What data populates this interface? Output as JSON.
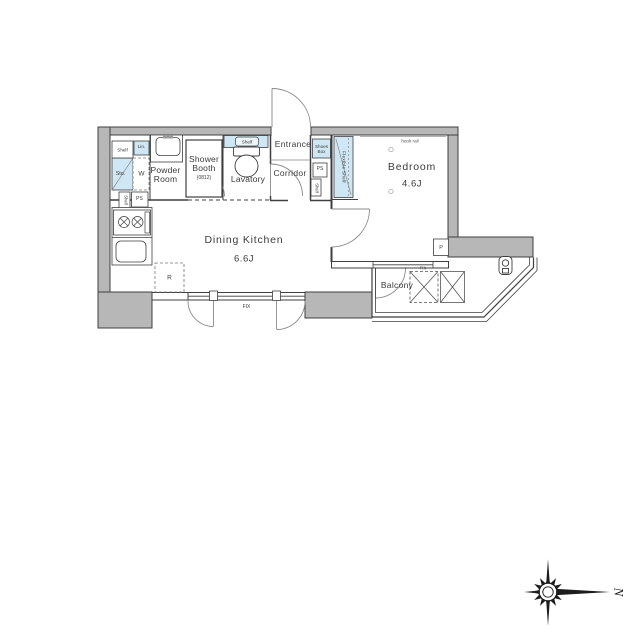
{
  "floorplan": {
    "rooms": {
      "dining_kitchen": {
        "label": "Dining Kitchen",
        "size": "6.6J"
      },
      "bedroom": {
        "label": "Bedroom",
        "size": "4.6J"
      },
      "entrance": {
        "label": "Entrance"
      },
      "corridor": {
        "label": "Corridor"
      },
      "lavatory": {
        "label": "Lavatory"
      },
      "powder_room": {
        "label": "Powder\nRoom"
      },
      "shower_booth": {
        "label": "Shower\nBooth",
        "size": "(0812)"
      },
      "balcony": {
        "label": "Balcony"
      }
    },
    "fixtures": {
      "shelf": "Shelf",
      "linen": "Lin.",
      "storage": "Sto.",
      "washer": "W",
      "pipe_space": "PS",
      "shoes_box": "Shoes\nBox",
      "flexible_shelf": "Flexible Shelf",
      "toilet_shelf": "Shelf",
      "refrigerator": "R",
      "pipe": "P",
      "fix_window": "FIX",
      "hook_rail": "hook rail"
    },
    "compass": {
      "north_label": "N"
    },
    "colors": {
      "wall_fill": "#b7b7b7",
      "fixture_blue": "#cfe7f4",
      "line": "#3f3f3f",
      "door_line": "#8a8a8a",
      "text": "#3b3b3b"
    }
  }
}
